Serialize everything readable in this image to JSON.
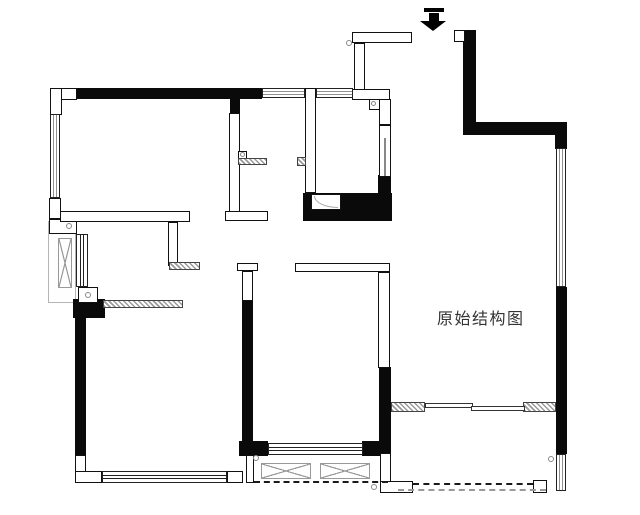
{
  "title": "原始结构图",
  "colors": {
    "wall": "#0a0a0a",
    "outline": "#111111",
    "hatch": "#9a9a9a",
    "marker": "#888888",
    "text": "#333333",
    "background": "#ffffff"
  },
  "plan": {
    "label": {
      "text": "原始结构图"
    },
    "entry_arrow": {
      "name": "entry-arrow-icon",
      "direction": "down"
    },
    "gray_boxes": [
      {
        "name": "elevator-shaft-area",
        "x": 48,
        "y": 221,
        "w": 28,
        "h": 82
      }
    ],
    "walls_solid": [
      {
        "name": "wall-bedroom1-top",
        "x": 77,
        "y": 88,
        "w": 185,
        "h": 11
      },
      {
        "name": "wall-bedroom1-right-top",
        "x": 230,
        "y": 99,
        "w": 10,
        "h": 14
      },
      {
        "name": "wall-bath-bottom",
        "x": 303,
        "y": 193,
        "w": 89,
        "h": 28
      },
      {
        "name": "wall-bath-right-lower",
        "x": 378,
        "y": 175,
        "w": 13,
        "h": 20
      },
      {
        "name": "wall-entry-right",
        "x": 463,
        "y": 30,
        "w": 13,
        "h": 105
      },
      {
        "name": "wall-top-right",
        "x": 463,
        "y": 122,
        "w": 104,
        "h": 13
      },
      {
        "name": "wall-right-stub",
        "x": 555,
        "y": 135,
        "w": 12,
        "h": 14
      },
      {
        "name": "wall-right-mid",
        "x": 556,
        "y": 287,
        "w": 11,
        "h": 167
      },
      {
        "name": "wall-living-left",
        "x": 379,
        "y": 367,
        "w": 12,
        "h": 76
      },
      {
        "name": "wall-mid-vertical",
        "x": 242,
        "y": 300,
        "w": 11,
        "h": 142
      },
      {
        "name": "wall-left-lower",
        "x": 75,
        "y": 315,
        "w": 11,
        "h": 140
      },
      {
        "name": "wall-left-corner-block",
        "x": 73,
        "y": 299,
        "w": 32,
        "h": 19
      },
      {
        "name": "wall-midroom-corner-left",
        "x": 239,
        "y": 441,
        "w": 29,
        "h": 15
      },
      {
        "name": "wall-midroom-corner-right",
        "x": 362,
        "y": 441,
        "w": 29,
        "h": 15
      }
    ],
    "walls_hollow": [
      {
        "name": "corner-topleft-h",
        "x": 50,
        "y": 88,
        "w": 27,
        "h": 12
      },
      {
        "name": "corner-topleft-v",
        "x": 50,
        "y": 88,
        "w": 12,
        "h": 27
      },
      {
        "name": "block-left-upper",
        "x": 49,
        "y": 198,
        "w": 12,
        "h": 21
      },
      {
        "name": "block-left-lower",
        "x": 49,
        "y": 219,
        "w": 28,
        "h": 15
      },
      {
        "name": "wall-bedroom1-bottom",
        "x": 60,
        "y": 211,
        "w": 130,
        "h": 11
      },
      {
        "name": "wall-dining-stub",
        "x": 168,
        "y": 222,
        "w": 10,
        "h": 44
      },
      {
        "name": "wall-bedroom1-right",
        "x": 229,
        "y": 113,
        "w": 11,
        "h": 99
      },
      {
        "name": "wall-bedroom1-right-foot",
        "x": 225,
        "y": 211,
        "w": 43,
        "h": 10
      },
      {
        "name": "wall-bath-left",
        "x": 305,
        "y": 88,
        "w": 11,
        "h": 105
      },
      {
        "name": "wall-entry-top",
        "x": 352,
        "y": 32,
        "w": 60,
        "h": 11
      },
      {
        "name": "wall-entry-vertical",
        "x": 354,
        "y": 43,
        "w": 11,
        "h": 47
      },
      {
        "name": "wall-bath-top",
        "x": 352,
        "y": 89,
        "w": 38,
        "h": 11
      },
      {
        "name": "pipe-box",
        "x": 369,
        "y": 99,
        "w": 11,
        "h": 11
      },
      {
        "name": "wall-bath-right-top",
        "x": 379,
        "y": 99,
        "w": 12,
        "h": 26
      },
      {
        "name": "wall-bath-right-doorzone",
        "x": 379,
        "y": 125,
        "w": 12,
        "h": 52
      },
      {
        "name": "block-entry-square",
        "x": 454,
        "y": 30,
        "w": 11,
        "h": 12
      },
      {
        "name": "wall-midroom-top",
        "x": 295,
        "y": 263,
        "w": 95,
        "h": 9
      },
      {
        "name": "wall-midroom-right-upper",
        "x": 378,
        "y": 272,
        "w": 12,
        "h": 96
      },
      {
        "name": "wall-mid-cap",
        "x": 237,
        "y": 263,
        "w": 21,
        "h": 8
      },
      {
        "name": "wall-mid-upper",
        "x": 242,
        "y": 271,
        "w": 11,
        "h": 30
      },
      {
        "name": "meter-box",
        "x": 78,
        "y": 287,
        "w": 20,
        "h": 16
      },
      {
        "name": "wall-balcony-mid-left",
        "x": 246,
        "y": 455,
        "w": 8,
        "h": 28
      },
      {
        "name": "corner-bottomleft-v",
        "x": 75,
        "y": 455,
        "w": 11,
        "h": 28
      },
      {
        "name": "corner-bottomleft-h",
        "x": 75,
        "y": 471,
        "w": 27,
        "h": 12
      },
      {
        "name": "corner-bedroom2-right",
        "x": 227,
        "y": 471,
        "w": 16,
        "h": 12
      },
      {
        "name": "wall-balcony-right-left",
        "x": 380,
        "y": 453,
        "w": 11,
        "h": 40
      },
      {
        "name": "wall-balcony-right-bottom-left",
        "x": 380,
        "y": 481,
        "w": 33,
        "h": 12
      },
      {
        "name": "wall-balcony-right-bottom-right",
        "x": 533,
        "y": 480,
        "w": 14,
        "h": 13
      },
      {
        "name": "shower-box",
        "x": 311,
        "y": 194,
        "w": 30,
        "h": 16
      },
      {
        "name": "counter-box",
        "x": 238,
        "y": 151,
        "w": 9,
        "h": 8
      }
    ],
    "windows": [
      {
        "name": "window-top-kitchen",
        "o": "h",
        "x": 262,
        "y": 88,
        "w": 43,
        "h": 10
      },
      {
        "name": "window-top-bath",
        "o": "h",
        "x": 316,
        "y": 88,
        "w": 37,
        "h": 10
      },
      {
        "name": "window-bedroom1-left",
        "o": "v",
        "x": 50,
        "y": 114,
        "w": 10,
        "h": 84
      },
      {
        "name": "window-left-mid",
        "o": "v",
        "x": 76,
        "y": 234,
        "w": 12,
        "h": 53
      },
      {
        "name": "window-bedroom2-bottom",
        "o": "h",
        "x": 102,
        "y": 471,
        "w": 125,
        "h": 12
      },
      {
        "name": "window-midroom-bottom",
        "o": "h",
        "x": 268,
        "y": 443,
        "w": 95,
        "h": 12
      },
      {
        "name": "window-right-upper",
        "o": "v",
        "x": 556,
        "y": 148,
        "w": 10,
        "h": 139
      },
      {
        "name": "window-right-lower",
        "o": "v",
        "x": 556,
        "y": 454,
        "w": 10,
        "h": 37
      }
    ],
    "hatches": [
      {
        "name": "hatch-counter",
        "x": 238,
        "y": 158,
        "w": 29,
        "h": 7
      },
      {
        "name": "hatch-bath-door",
        "x": 297,
        "y": 157,
        "w": 9,
        "h": 9
      },
      {
        "name": "hatch-stub-end",
        "x": 169,
        "y": 262,
        "w": 31,
        "h": 8
      },
      {
        "name": "hatch-left-long",
        "x": 103,
        "y": 300,
        "w": 80,
        "h": 8
      },
      {
        "name": "hatch-living-bottom-left",
        "x": 391,
        "y": 402,
        "w": 34,
        "h": 10
      },
      {
        "name": "hatch-living-bottom-right",
        "x": 523,
        "y": 402,
        "w": 33,
        "h": 10
      }
    ],
    "xboxes": [
      {
        "name": "shaft-xbox",
        "x": 58,
        "y": 238,
        "w": 14,
        "h": 50
      },
      {
        "name": "balcony-xbox-1",
        "x": 261,
        "y": 463,
        "w": 50,
        "h": 16
      },
      {
        "name": "balcony-xbox-2",
        "x": 320,
        "y": 463,
        "w": 50,
        "h": 16
      }
    ],
    "door_panels": [
      {
        "name": "sliding-panel-1",
        "x": 425,
        "y": 403,
        "w": 48,
        "h": 5
      },
      {
        "name": "sliding-panel-2",
        "x": 471,
        "y": 406,
        "w": 54,
        "h": 5
      }
    ],
    "dashed": [
      {
        "name": "balcony-mid-edge",
        "x": 254,
        "y": 481,
        "w": 134
      },
      {
        "name": "balcony-right-edge-1",
        "x": 413,
        "y": 483,
        "w": 120
      },
      {
        "name": "balcony-right-edge-2",
        "x": 398,
        "y": 489,
        "w": 148,
        "light": true
      }
    ],
    "dots": [
      {
        "name": "marker-dot-entry",
        "x": 346,
        "y": 40,
        "s": 6
      },
      {
        "name": "marker-dot-left-1",
        "x": 66,
        "y": 223,
        "s": 6
      },
      {
        "name": "marker-dot-left-2",
        "x": 85,
        "y": 292,
        "s": 6
      },
      {
        "name": "marker-dot-balcony-mid",
        "x": 253,
        "y": 455,
        "s": 6
      },
      {
        "name": "marker-dot-balcony-right-1",
        "x": 548,
        "y": 456,
        "s": 6
      },
      {
        "name": "marker-dot-balcony-right-2",
        "x": 371,
        "y": 484,
        "s": 6
      },
      {
        "name": "marker-dot-pipe",
        "x": 371,
        "y": 101,
        "s": 5
      },
      {
        "name": "marker-dot-counter",
        "x": 240,
        "y": 152,
        "s": 5
      }
    ],
    "door_lines": [
      {
        "name": "bath-door-leaf",
        "x": 384,
        "y": 138,
        "w": 2,
        "h": 38
      }
    ],
    "arcs": [
      {
        "name": "shower-arc",
        "x": 314,
        "y": 196,
        "w": 24,
        "h": 12
      }
    ]
  }
}
